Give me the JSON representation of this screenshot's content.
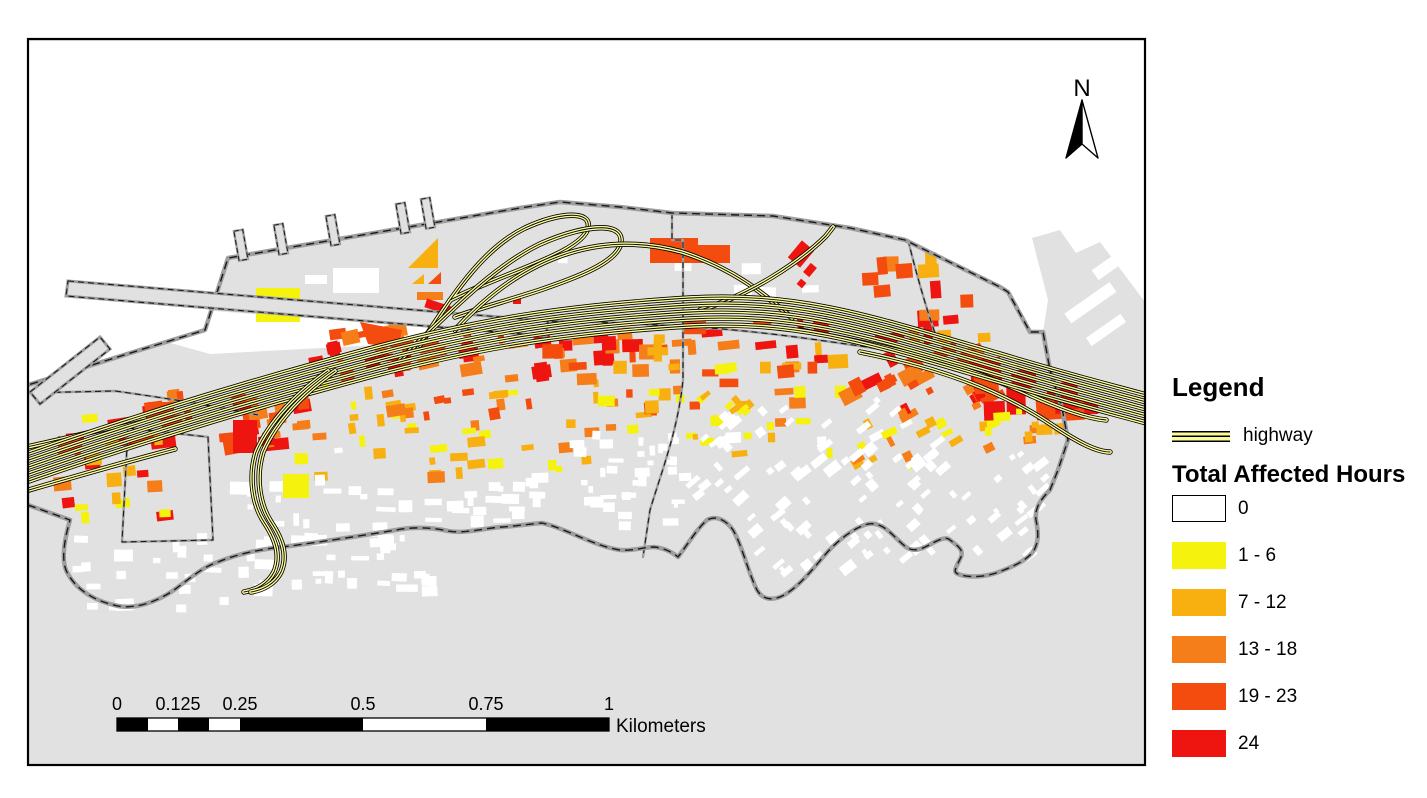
{
  "legend": {
    "title": "Legend",
    "highway_label": "highway",
    "section_title": "Total Affected Hours",
    "classes": [
      {
        "label": "0",
        "color": "#FFFFFF"
      },
      {
        "label": "1 - 6",
        "color": "#F5F20E"
      },
      {
        "label": "7 - 12",
        "color": "#F7B010"
      },
      {
        "label": "13 - 18",
        "color": "#F57E1B"
      },
      {
        "label": "19 - 23",
        "color": "#F44C0E"
      },
      {
        "label": "24",
        "color": "#EE1410"
      }
    ]
  },
  "scale_bar": {
    "labels": [
      "0",
      "0.125",
      "0.25",
      "0.5",
      "0.75",
      "1"
    ],
    "unit": "Kilometers"
  },
  "north_arrow": {
    "label": "N"
  },
  "colors": {
    "water": "#FFFFFF",
    "land": "#E1E1E1",
    "boundary_casing": "#9E9E9E",
    "boundary_dash": "#1A1A1A",
    "highway_fill": "#FBFB9E",
    "highway_casing": "#000000",
    "frame_border": "#000000"
  }
}
